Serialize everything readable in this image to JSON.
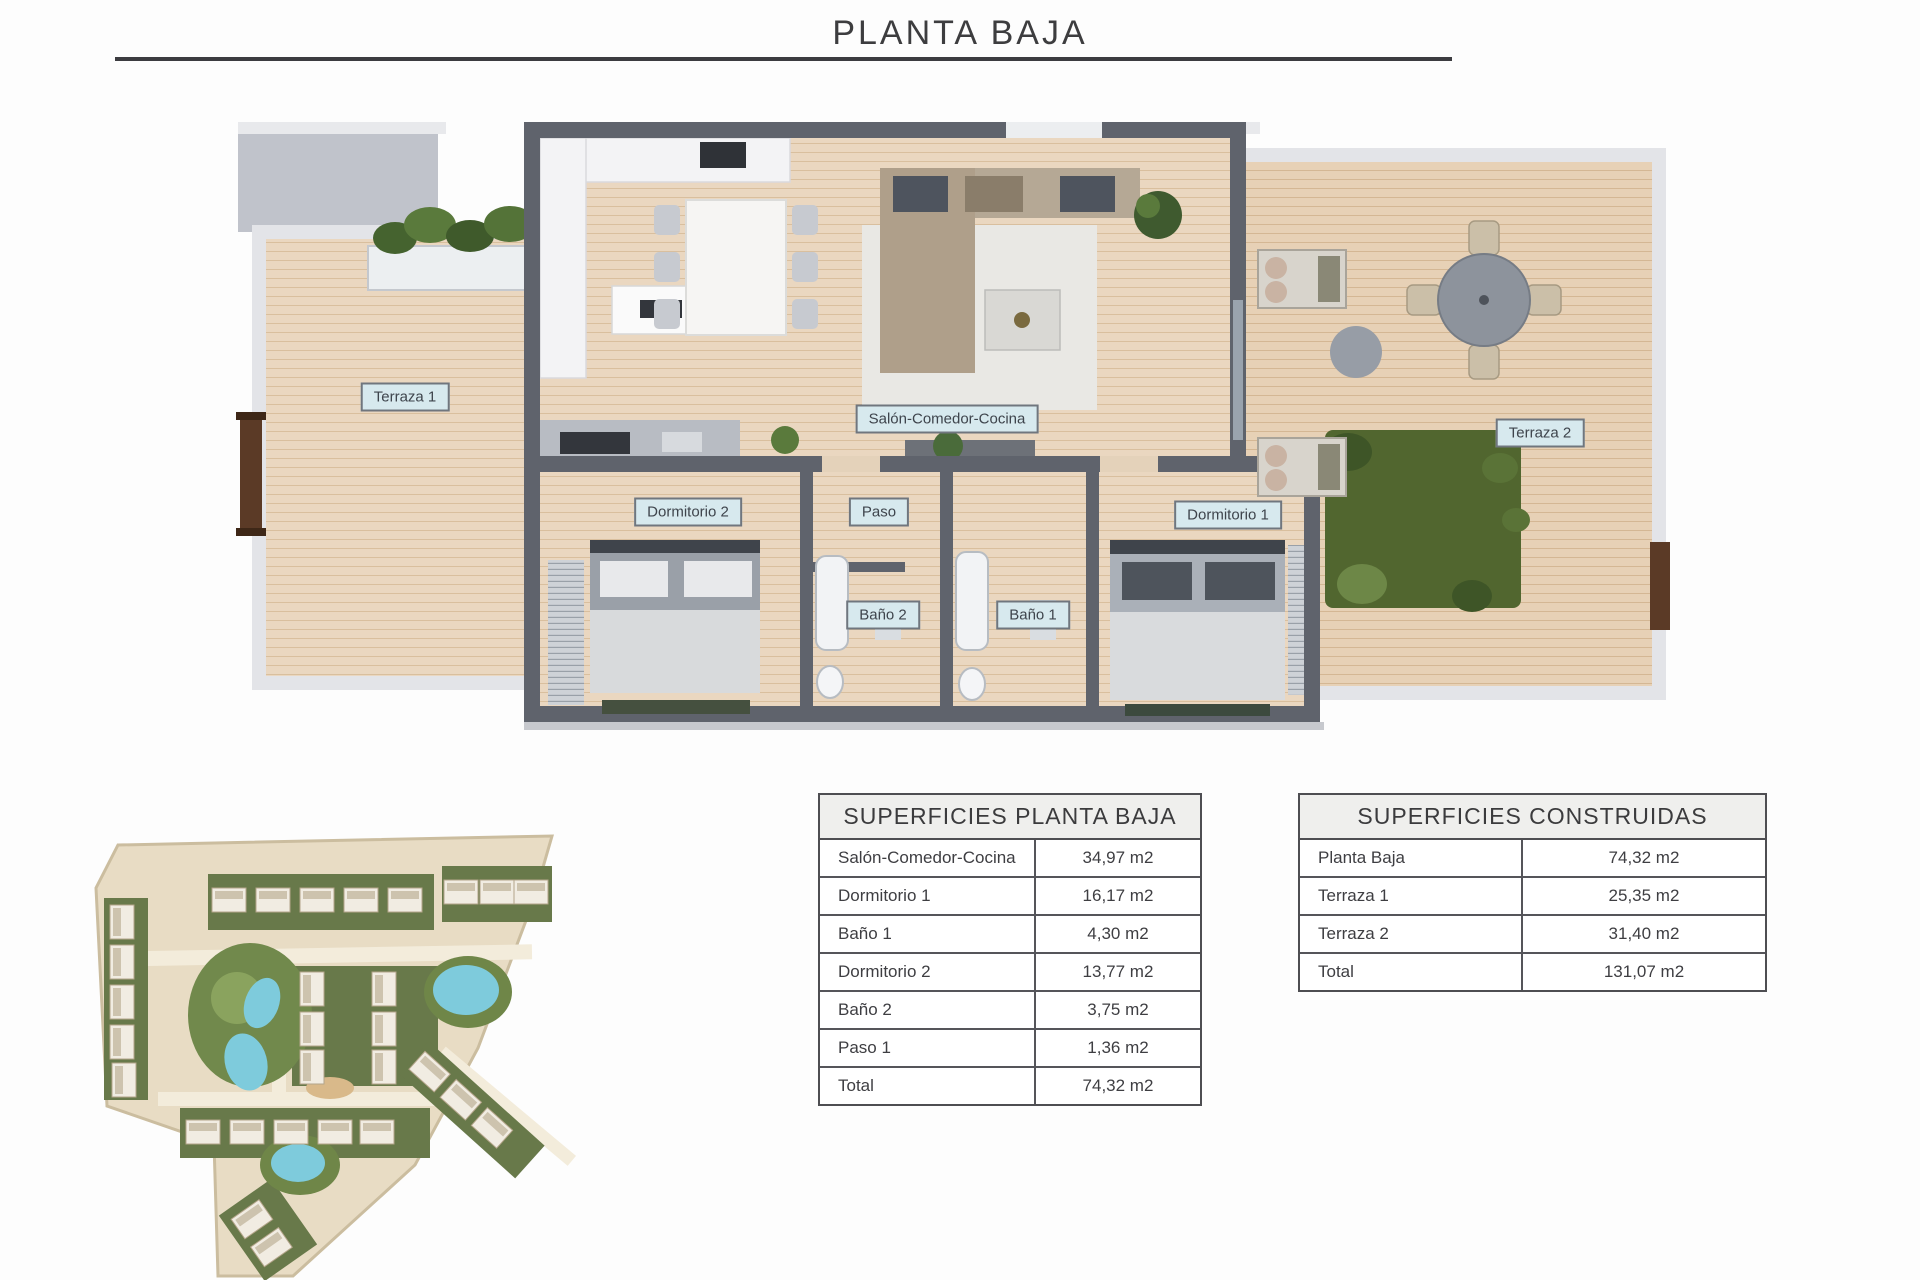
{
  "page": {
    "title": "PLANTA BAJA"
  },
  "floor_plan": {
    "room_labels": [
      {
        "id": "terraza-1",
        "label": "Terraza 1"
      },
      {
        "id": "salon-comedor-cocina",
        "label": "Salón-Comedor-Cocina"
      },
      {
        "id": "dormitorio-2",
        "label": "Dormitorio 2"
      },
      {
        "id": "paso",
        "label": "Paso"
      },
      {
        "id": "dormitorio-1",
        "label": "Dormitorio 1"
      },
      {
        "id": "bano-2",
        "label": "Baño 2"
      },
      {
        "id": "bano-1",
        "label": "Baño 1"
      },
      {
        "id": "terraza-2",
        "label": "Terraza 2"
      }
    ]
  },
  "tables": {
    "planta_baja": {
      "title": "SUPERFICIES PLANTA BAJA",
      "rows": [
        {
          "label": "Salón-Comedor-Cocina",
          "value": "34,97 m2"
        },
        {
          "label": "Dormitorio 1",
          "value": "16,17 m2"
        },
        {
          "label": "Baño 1",
          "value": "4,30 m2"
        },
        {
          "label": "Dormitorio 2",
          "value": "13,77 m2"
        },
        {
          "label": "Baño 2",
          "value": "3,75 m2"
        },
        {
          "label": "Paso 1",
          "value": "1,36 m2"
        },
        {
          "label": "Total",
          "value": "74,32 m2"
        }
      ]
    },
    "construidas": {
      "title": "SUPERFICIES CONSTRUIDAS",
      "rows": [
        {
          "label": "Planta Baja",
          "value": "74,32 m2"
        },
        {
          "label": "Terraza 1",
          "value": "25,35 m2"
        },
        {
          "label": "Terraza 2",
          "value": "31,40 m2"
        },
        {
          "label": "Total",
          "value": "131,07 m2"
        }
      ]
    }
  },
  "colors": {
    "label_bg": "#d7e9ee",
    "wall_dark": "#5f636c",
    "wall_light": "#e3e4e8",
    "wood_floor": "#ead7c0",
    "grass": "#51662f",
    "pool": "#7ecbdc",
    "table_border": "#4e4e52",
    "table_header_bg": "#efefed"
  }
}
